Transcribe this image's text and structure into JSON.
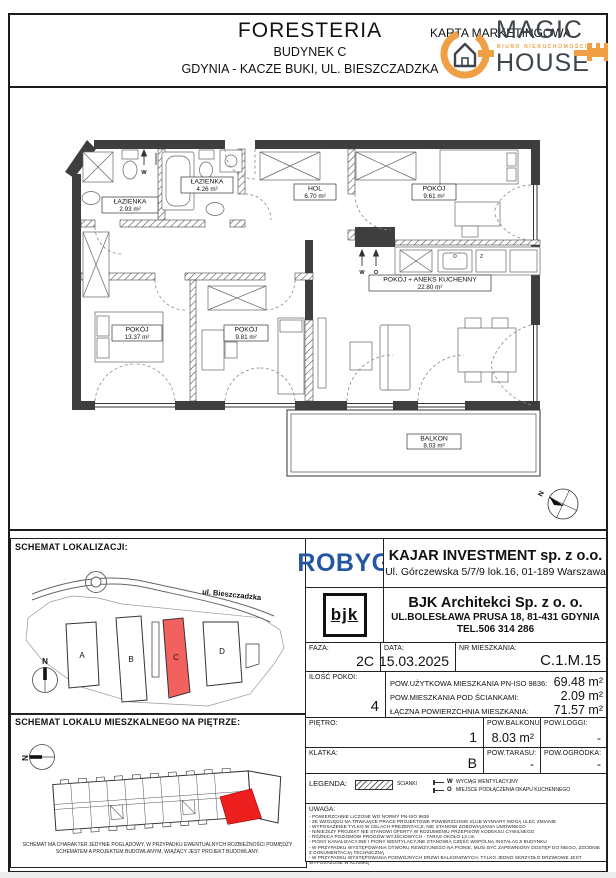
{
  "colors": {
    "wall_dark": "#3e3e3e",
    "accent_orange": "#f09f45",
    "logo_gray": "#3d444b",
    "robyg_blue": "#2456a4",
    "site_highlight_red": "#f2615e",
    "unit_highlight_red": "#ee1f1f"
  },
  "header": {
    "project": "FORESTERIA",
    "building": "BUDYNEK C",
    "location": "GDYNIA - KACZE BUKI, UL. BIESZCZADZKA",
    "card_type": "KARTA MARKETINGOWA",
    "logo": {
      "word1": "MAGIC",
      "tagline": "BIURO NIERUCHOMOŚCI",
      "word2": "HOUSE"
    }
  },
  "floor_plan": {
    "north_label": "N",
    "symbol_w": "W",
    "symbol_o": "O",
    "symbol_z": "Z",
    "rooms": [
      {
        "name": "ŁAZIENKA",
        "area": "2.93 m²"
      },
      {
        "name": "ŁAZIENKA",
        "area": "4.26 m²"
      },
      {
        "name": "HOL",
        "area": "6.70 m²"
      },
      {
        "name": "POKÓJ",
        "area": "9.61 m²"
      },
      {
        "name": "POKÓJ + ANEKS KUCHENNY",
        "area": "22.80 m²"
      },
      {
        "name": "POKÓJ",
        "area": "13.37 m²"
      },
      {
        "name": "POKÓJ",
        "area": "9.81 m²"
      },
      {
        "name": "BALKON",
        "area": "8.03 m²"
      }
    ]
  },
  "location_map": {
    "title": "SCHEMAT LOKALIZACJI:",
    "street": "ul. Bieszczadzka",
    "north_label": "N",
    "buildings": [
      {
        "label": "A",
        "highlighted": false
      },
      {
        "label": "B",
        "highlighted": false
      },
      {
        "label": "C",
        "highlighted": true
      },
      {
        "label": "D",
        "highlighted": false
      }
    ]
  },
  "floor_schematic": {
    "title": "SCHEMAT LOKALU MIESZKALNEGO NA PIĘTRZE:",
    "north_label": "N",
    "caption_line1": "SCHEMAT MA CHARAKTER JEDYNIE POGLĄDOWY, W PRZYPADKU EWENTUALNYCH ROZBIEŻNOŚCI POMIĘDZY",
    "caption_line2": "SCHEMATEM A PROJEKTEM BUDOWLANYM, WIĄŻĄCY JEST PROJEKT BUDOWLANY."
  },
  "developer": {
    "logo_text": "ROBYG",
    "name": "KAJAR INVESTMENT sp. z o.o.",
    "address": "Ul. Górczewska 5/7/9 lok.16, 01-189 Warszawa"
  },
  "architect": {
    "logo_text": "bjk",
    "name": "BJK Architekci Sp. z o. o.",
    "address": "UL.BOLESŁAWA PRUSA 18, 81-431 GDYNIA",
    "phone": "TEL.506 314 286"
  },
  "details": {
    "faza": {
      "label": "FAZA:",
      "value": "2C"
    },
    "data": {
      "label": "DATA:",
      "value": "15.03.2025"
    },
    "nr_mieszkania": {
      "label": "NR MIESZKANIA:",
      "value": "C.1.M.15"
    },
    "ilosc_pokoi": {
      "label": "ILOŚĆ POKOI:",
      "value": "4"
    },
    "areas": [
      {
        "label": "POW.UŻYTKOWA MIESZKANIA PN-ISO 9836:",
        "value": "69.48 m²"
      },
      {
        "label": "POW.MIESZKANIA POD ŚCIANKAMI:",
        "value": "2.09 m²"
      },
      {
        "label": "ŁĄCZNA POWIERZCHNIA MIESZKANIA:",
        "value": "71.57 m²"
      }
    ],
    "pietro": {
      "label": "PIĘTRO:",
      "value": "1"
    },
    "pow_balkonu": {
      "label": "POW.BALKONU:",
      "value": "8.03 m²"
    },
    "pow_loggi": {
      "label": "POW.LOGGI:",
      "value": "-"
    },
    "klatka": {
      "label": "KLATKA:",
      "value": "B"
    },
    "pow_tarasu": {
      "label": "POW.TARASU:",
      "value": "-"
    },
    "pow_ogrodka": {
      "label": "POW.OGRÓDKA:",
      "value": "-"
    }
  },
  "legend": {
    "label": "LEGENDA:",
    "scianki": "ŚCIANKI",
    "items": [
      {
        "symbol": "W",
        "desc": "WYCIĄG WENTYLACYJNY"
      },
      {
        "symbol": "O",
        "desc": "MIEJSCE PODŁĄCZENIA OKAPU KUCHENNEGO"
      }
    ]
  },
  "uwaga": {
    "label": "UWAGA:",
    "lines": [
      "- POWIERZCHNIE LICZONE WG NORMY PN-ISO 9836",
      "- ZE WZGLĘDU NA TRWAJĄCE PRACE PROJEKTOWE POWIERZCHNIE I/LUB WYMIARY MOGĄ ULEC ZMIANIE",
      "- WYPOSAŻENIE TYLKO W CELACH PREZENTACJI, NIE STANOWI ZOBOWIĄZANIA UMOWNEGO",
      "- NINIEJSZY PROJEKT NIE STANOWI OFERTY W ROZUMIENIU PRZEPISÓW KODEKSU CYWILNEGO",
      "- RÓŻNICA POZIOMÓW PROGÓW WYJŚCIOWYCH - TARAS OKOŁO 13 cm",
      "- PIONY KANALIZACYJNE I PIONY WENTYLACYJNE STANOWIĄ CZĘŚĆ WSPÓLNĄ INSTALACJI BUDYNKU",
      "- W PRZYPADKU WYSTĘPOWANIA OTWORU REWIZYJNEGO NA PIONIE, MUSI BYĆ ZAPEWNIONY DOSTĘP DO NIEGO, ZGODNIE Z DOKUMENTACJĄ TECHNICZNĄ",
      "- W PRZYPADKU WYSTĘPOWANIA PODWÓJNYCH DRZWI BALKONOWYCH, TYLKO JEDNO SKRZYDŁO DRZWIOWE JEST WYPOSAŻONE W KLAMKĘ"
    ]
  }
}
